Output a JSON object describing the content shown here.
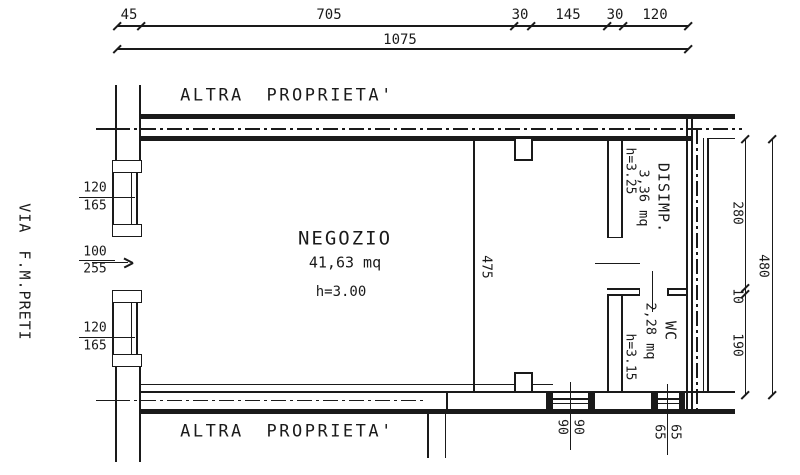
{
  "street_label": "VIA F.M.PRETI",
  "adjacent_top": {
    "label": "ALTRA PROPRIETA'"
  },
  "adjacent_bottom": {
    "label": "ALTRA PROPRIETA'"
  },
  "rooms": {
    "negozio": {
      "name": "NEGOZIO",
      "area": "41,63 mq",
      "height": "h=3.00"
    },
    "disimpegno": {
      "name": "DISIMP.",
      "area": "3,36 mq",
      "height": "h=3.25"
    },
    "wc": {
      "name": "WC",
      "area": "2,28 mq",
      "height": "h=3.15"
    }
  },
  "dimensions": {
    "top_segments": [
      "45",
      "705",
      "30",
      "145",
      "30",
      "120"
    ],
    "top_total": "1075",
    "right_segments": [
      "280",
      "10",
      "190"
    ],
    "right_total": "480",
    "interior_depth": "475"
  },
  "openings": {
    "window_upper": {
      "width": "120",
      "height": "165"
    },
    "door": {
      "width": "100",
      "height": "255"
    },
    "window_lower": {
      "width": "120",
      "height": "165"
    },
    "shop_window": {
      "width": "90",
      "height": "90"
    },
    "wc_window": {
      "width": "65",
      "height": "65"
    }
  },
  "colors": {
    "line": "#1a1a1a",
    "background": "#ffffff"
  }
}
